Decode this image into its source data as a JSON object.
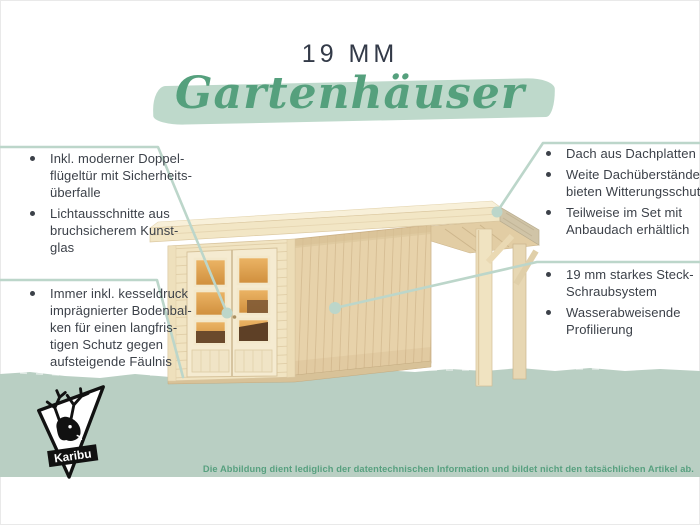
{
  "page": {
    "title_line": "19 MM",
    "script_title": "Gartenhäuser",
    "disclaimer": "Die Abbildung dient lediglich der datentechnischen Information und bildet nicht den tatsächlichen Artikel ab."
  },
  "brand": {
    "logo_label": "Karibu",
    "logo_icon": "deer-head-triangle-logo"
  },
  "callouts": {
    "left_top": {
      "items": [
        [
          "Inkl. moderner Doppel-",
          "flügeltür mit Sicherheits-",
          "überfalle"
        ],
        [
          "Lichtausschnitte aus",
          "bruchsicherem Kunst-",
          "glas"
        ]
      ]
    },
    "left_bottom": {
      "items": [
        [
          "Immer inkl. kesseldruck",
          "imprägnierter Bodenbal-",
          "ken für einen langfris-",
          "tigen Schutz gegen",
          "aufsteigende Fäulnis"
        ]
      ]
    },
    "right_top": {
      "items": [
        [
          "Dach aus Dachplatten"
        ],
        [
          "Weite Dachüberstände",
          "bieten Witterungsschutz"
        ],
        [
          "Teilweise im Set mit",
          "Anbaudach erhältlich"
        ]
      ]
    },
    "right_bottom": {
      "items": [
        [
          "19 mm starkes Steck-",
          "Schraubsystem"
        ],
        [
          "Wasserabweisende",
          "Profilierung"
        ]
      ]
    }
  },
  "colors": {
    "accent_green": "#55a07d",
    "band_green": "#b9cfc3",
    "callout_line_green": "#bcd6ca",
    "brush_green": "#bed9cb",
    "title_navy": "#333a48",
    "body_text": "#3c4149",
    "wood_light": "#f1e4c2",
    "wood_side": "#e7d2aa",
    "glass_amber": "#dd9d4f"
  }
}
